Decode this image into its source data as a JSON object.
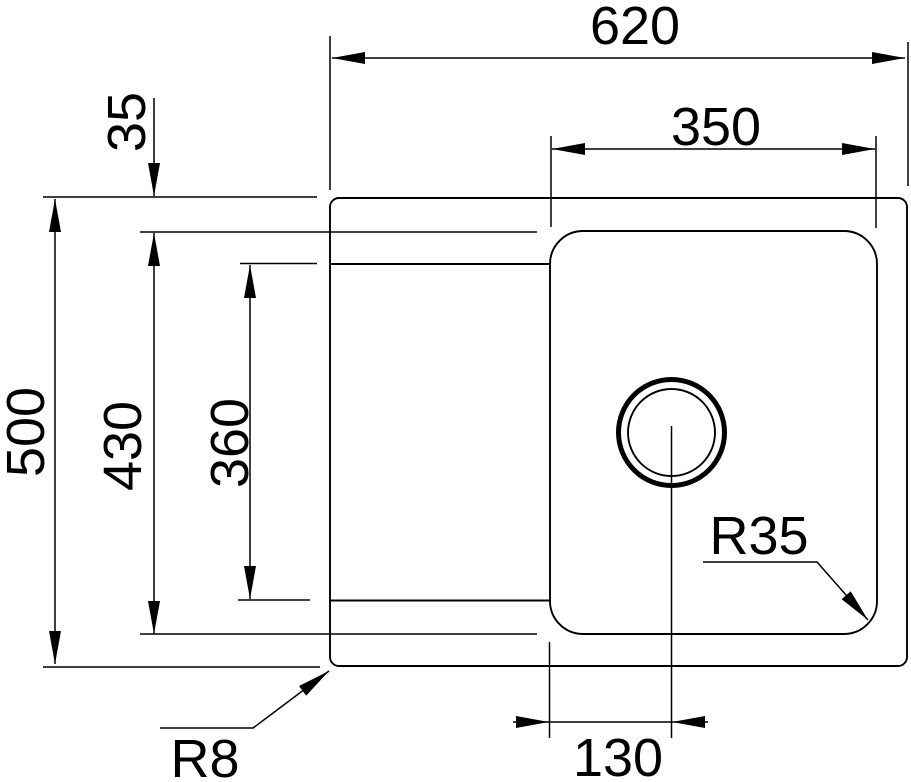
{
  "diagram": {
    "title": "sink-top-view-technical-drawing",
    "background_color": "#ffffff",
    "line_color": "#000000",
    "dimensions": {
      "overall_width": {
        "label": "620"
      },
      "bowl_width": {
        "label": "350"
      },
      "rim_top_offset": {
        "label": "35"
      },
      "overall_depth": {
        "label": "500"
      },
      "bowl_depth": {
        "label": "430"
      },
      "inner_depth": {
        "label": "360"
      },
      "drain_offset": {
        "label": "130"
      },
      "bowl_corner_radius": {
        "label": "R35"
      },
      "outer_corner_radius": {
        "label": "R8"
      }
    }
  }
}
